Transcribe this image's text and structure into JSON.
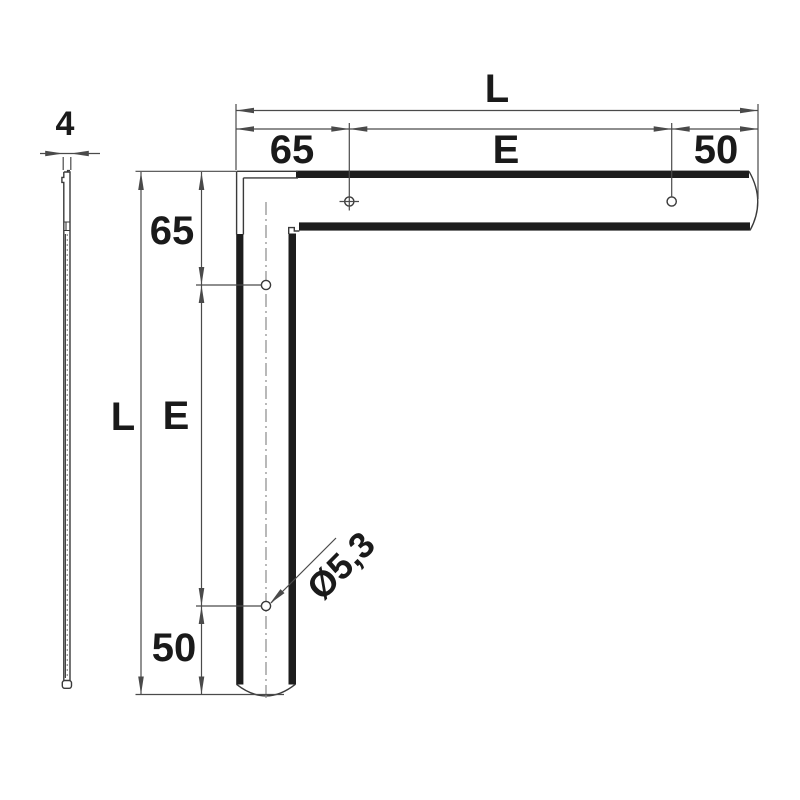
{
  "colors": {
    "background": "#ffffff",
    "outline": "#3a3a3a",
    "band": "#1d1d1d",
    "dimension": "#4a4a4a",
    "text": "#1a1a1a",
    "centerline": "#8a8a8a",
    "stipple": "#999999"
  },
  "side_view": {
    "thickness_label": "4"
  },
  "main_view": {
    "top_dimensions": {
      "total": "L",
      "left": "65",
      "center": "E",
      "right": "50"
    },
    "left_dimensions": {
      "total": "L",
      "top": "65",
      "center": "E",
      "bottom": "50"
    },
    "hole_label": "Ø5,3"
  }
}
